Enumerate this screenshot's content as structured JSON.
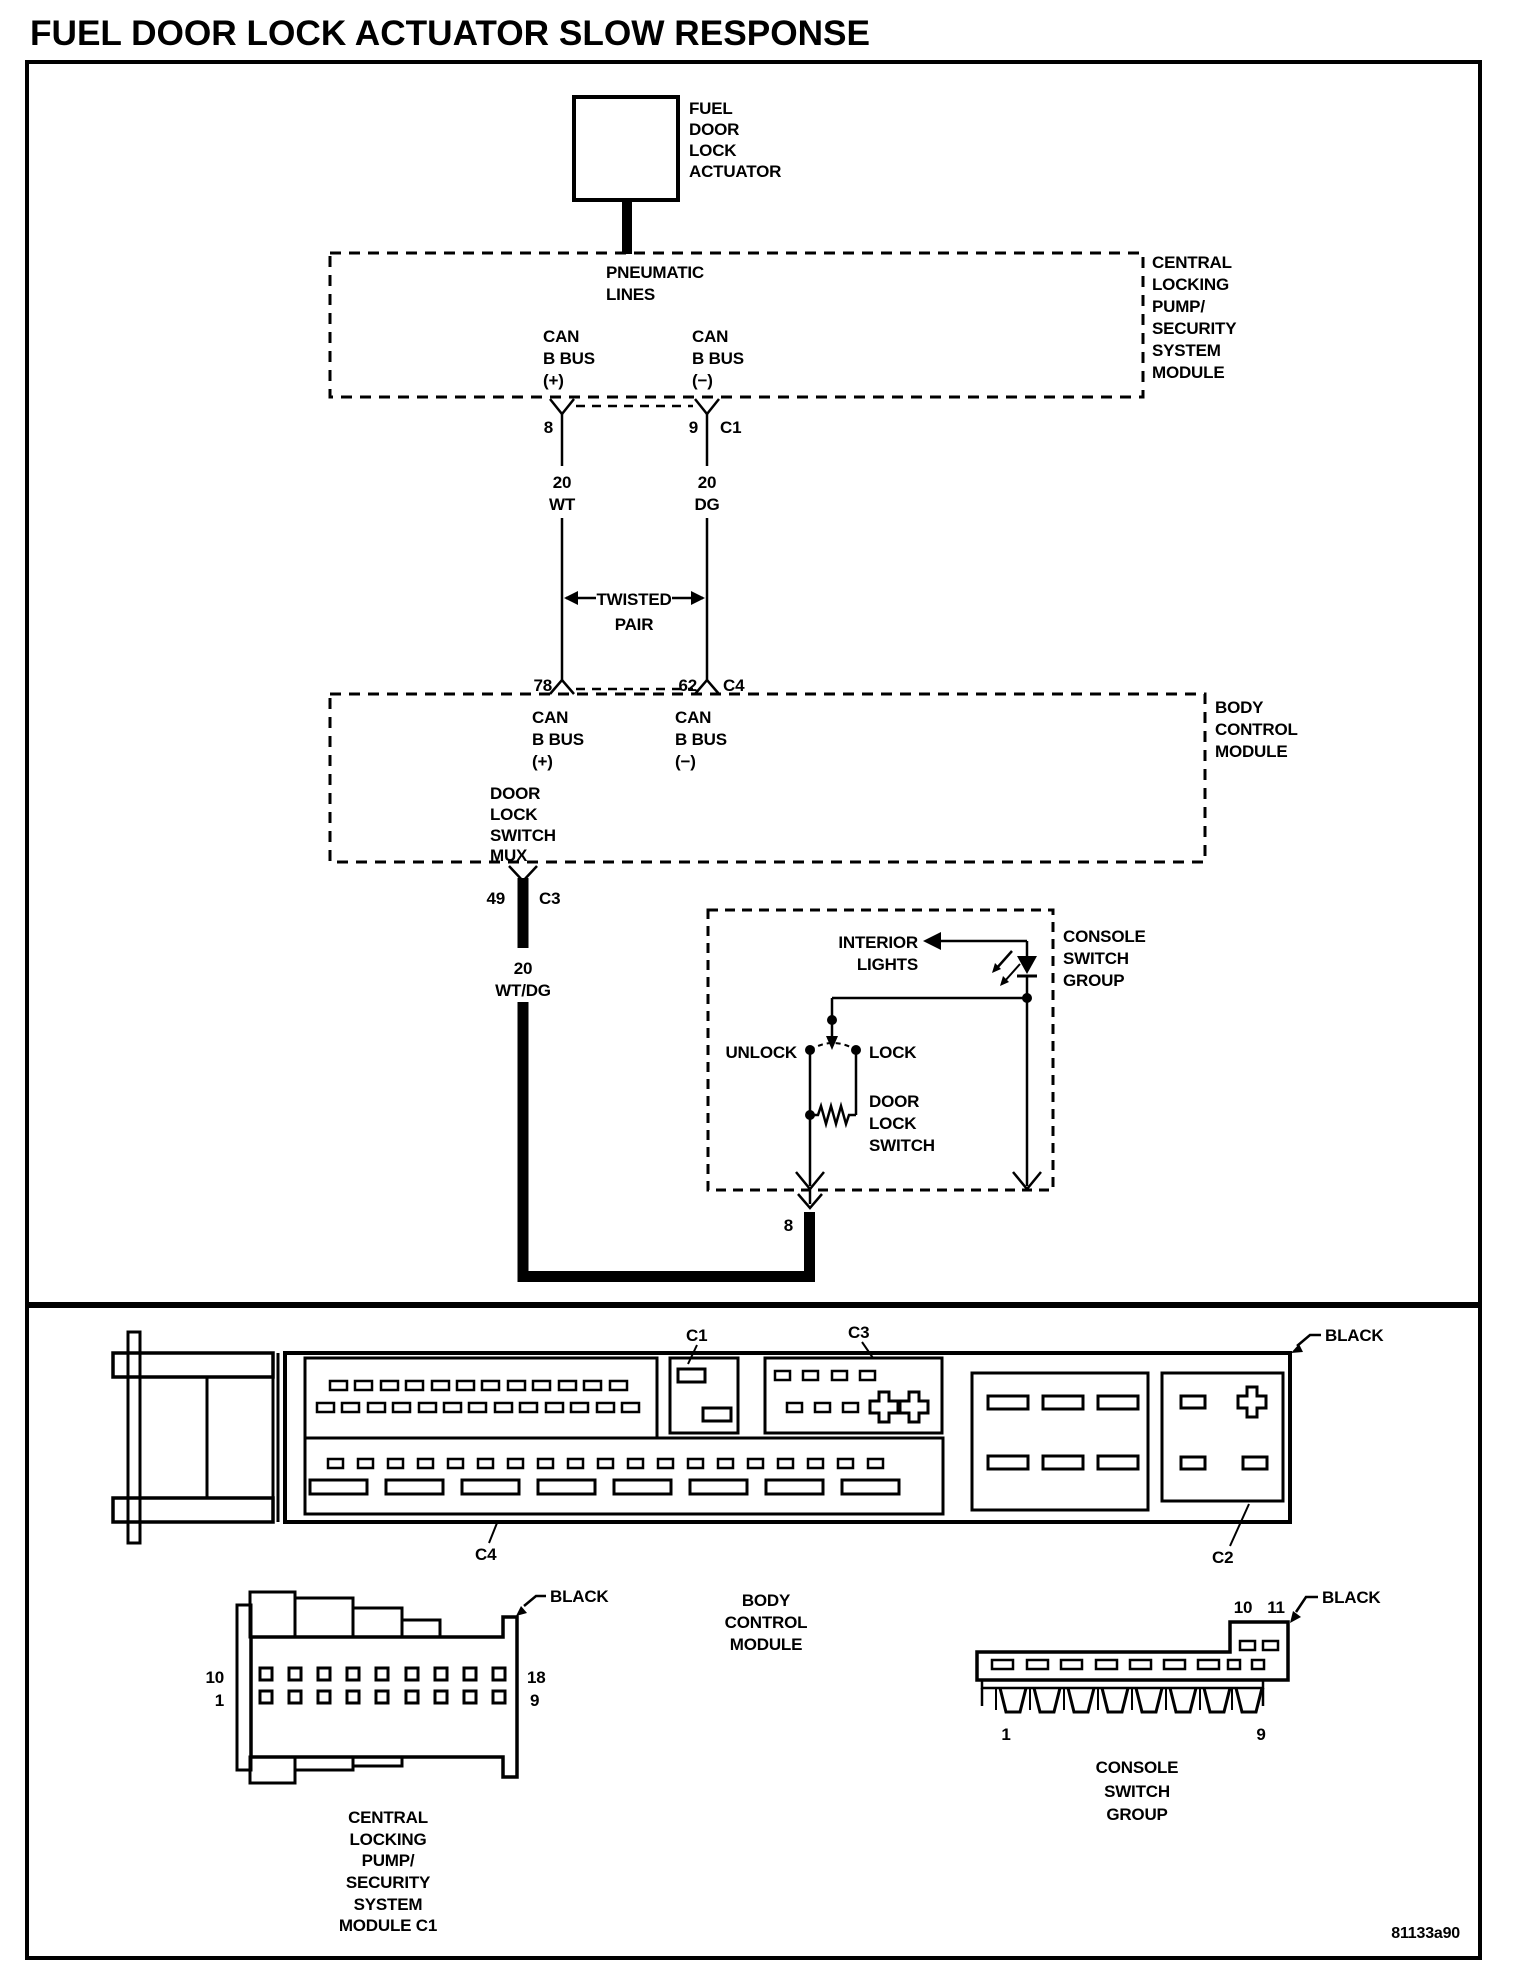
{
  "title": "FUEL DOOR LOCK ACTUATOR SLOW RESPONSE",
  "figure_code": "81133a90",
  "actuator": {
    "lines": [
      "FUEL",
      "DOOR",
      "LOCK",
      "ACTUATOR"
    ]
  },
  "clpm": {
    "label": [
      "CENTRAL",
      "LOCKING",
      "PUMP/",
      "SECURITY",
      "SYSTEM",
      "MODULE"
    ],
    "pneumatic": [
      "PNEUMATIC",
      "LINES"
    ],
    "can_plus": [
      "CAN",
      "B BUS",
      "(+)"
    ],
    "can_minus": [
      "CAN",
      "B BUS",
      "(−)"
    ],
    "pin8": "8",
    "pin9": "9",
    "conn": "C1"
  },
  "harness": {
    "w1": [
      "20",
      "WT"
    ],
    "w2": [
      "20",
      "DG"
    ],
    "twisted": [
      "TWISTED",
      "PAIR"
    ]
  },
  "bcm": {
    "label": [
      "BODY",
      "CONTROL",
      "MODULE"
    ],
    "pin78": "78",
    "pin62": "62",
    "conn": "C4",
    "can_plus": [
      "CAN",
      "B BUS",
      "(+)"
    ],
    "can_minus": [
      "CAN",
      "B BUS",
      "(−)"
    ],
    "mux": [
      "DOOR",
      "LOCK",
      "SWITCH",
      "MUX"
    ],
    "pin49": "49",
    "connc3": "C3",
    "wire": [
      "20",
      "WT/DG"
    ]
  },
  "console": {
    "label": [
      "CONSOLE",
      "SWITCH",
      "GROUP"
    ],
    "interior": [
      "INTERIOR",
      "LIGHTS"
    ],
    "unlock": "UNLOCK",
    "lock": "LOCK",
    "switch": [
      "DOOR",
      "LOCK",
      "SWITCH"
    ],
    "pin8": "8"
  },
  "connector_views": {
    "bcm": {
      "c1": "C1",
      "c2": "C2",
      "c3": "C3",
      "c4": "C4",
      "color": "BLACK",
      "caption": [
        "BODY",
        "CONTROL",
        "MODULE"
      ]
    },
    "clpm": {
      "color": "BLACK",
      "pin10": "10",
      "pin1": "1",
      "pin18": "18",
      "pin9": "9",
      "caption": [
        "CENTRAL",
        "LOCKING",
        "PUMP/",
        "SECURITY",
        "SYSTEM",
        "MODULE C1"
      ]
    },
    "csg": {
      "color": "BLACK",
      "pin10": "10",
      "pin11": "11",
      "pin1": "1",
      "pin9": "9",
      "caption": [
        "CONSOLE",
        "SWITCH",
        "GROUP"
      ]
    }
  }
}
